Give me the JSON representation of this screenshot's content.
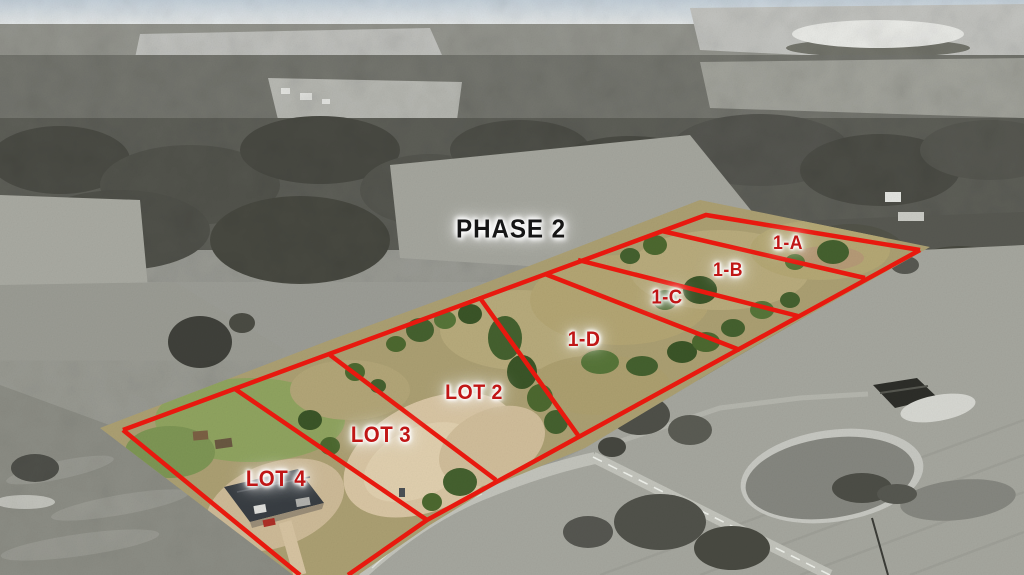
{
  "page": {
    "kind": "aerial-subdivision-lot-photo"
  },
  "phase_label": "PHASE 2",
  "lots": [
    {
      "id": "1-A",
      "label": "1-A"
    },
    {
      "id": "1-B",
      "label": "1-B"
    },
    {
      "id": "1-C",
      "label": "1-C"
    },
    {
      "id": "1-D",
      "label": "1-D"
    },
    {
      "id": "lot-2",
      "label": "LOT 2"
    },
    {
      "id": "lot-3",
      "label": "LOT 3"
    },
    {
      "id": "lot-4",
      "label": "LOT 4"
    }
  ],
  "colors": {
    "boundary-red": "#e8190f",
    "lot-label-red": "#c01616",
    "phase-label-black": "#161616",
    "label-glow": "#ffffff"
  }
}
